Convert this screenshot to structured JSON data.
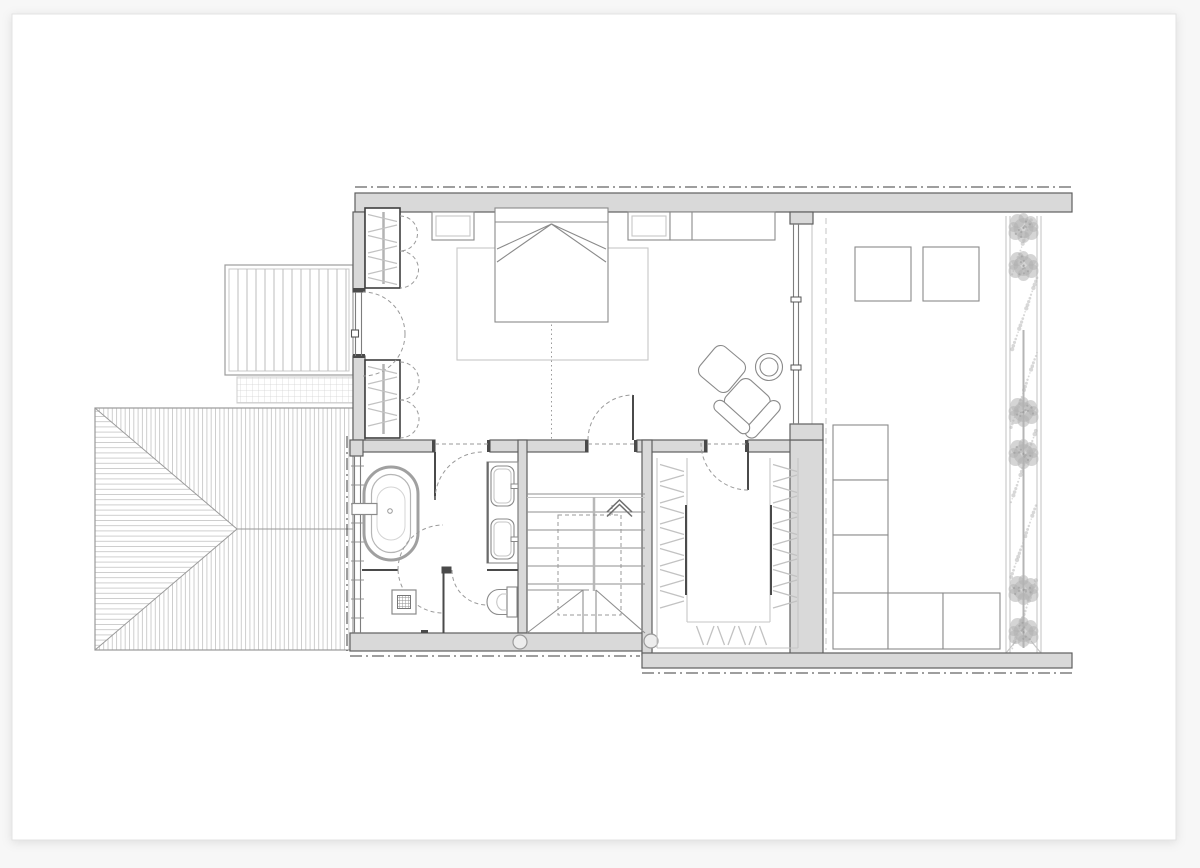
{
  "canvas": {
    "background": "#f7f7f7",
    "sheet": "#ffffff",
    "sheet_border": "#e3e3e3"
  },
  "palette": {
    "wall_fill": "#d9d9d9",
    "wall_stroke": "#5f5f5f",
    "line_dark": "#4a4a4a",
    "line_mid": "#8f8f8f",
    "line_light": "#c6c6c6",
    "hatch": "#c2c2c2",
    "dashed": "#9a9a9a",
    "axis_dash": "#3c3c3c",
    "vegetation": "#b2b2b2",
    "furniture_stroke": "#8a8a8a"
  },
  "drawing": {
    "type": "architectural-floor-plan",
    "text_labels": [],
    "elements": [
      "hipped-roof",
      "balcony-deck",
      "glass-canopy",
      "bedroom",
      "double-bed",
      "nightstand-left",
      "nightstand-right",
      "rug",
      "sideboard",
      "armchair",
      "ottoman",
      "side-table",
      "built-in-wardrobe-upper",
      "built-in-wardrobe-lower",
      "balcony-door",
      "bathroom",
      "freestanding-bathtub",
      "double-vanity",
      "shower-drain",
      "wall-hung-toilet",
      "staircase-with-winders",
      "up-arrow",
      "walk-in-closet",
      "hanging-rails",
      "terrace",
      "skylight-squares",
      "modular-sofa",
      "planting-strip",
      "columns"
    ]
  }
}
